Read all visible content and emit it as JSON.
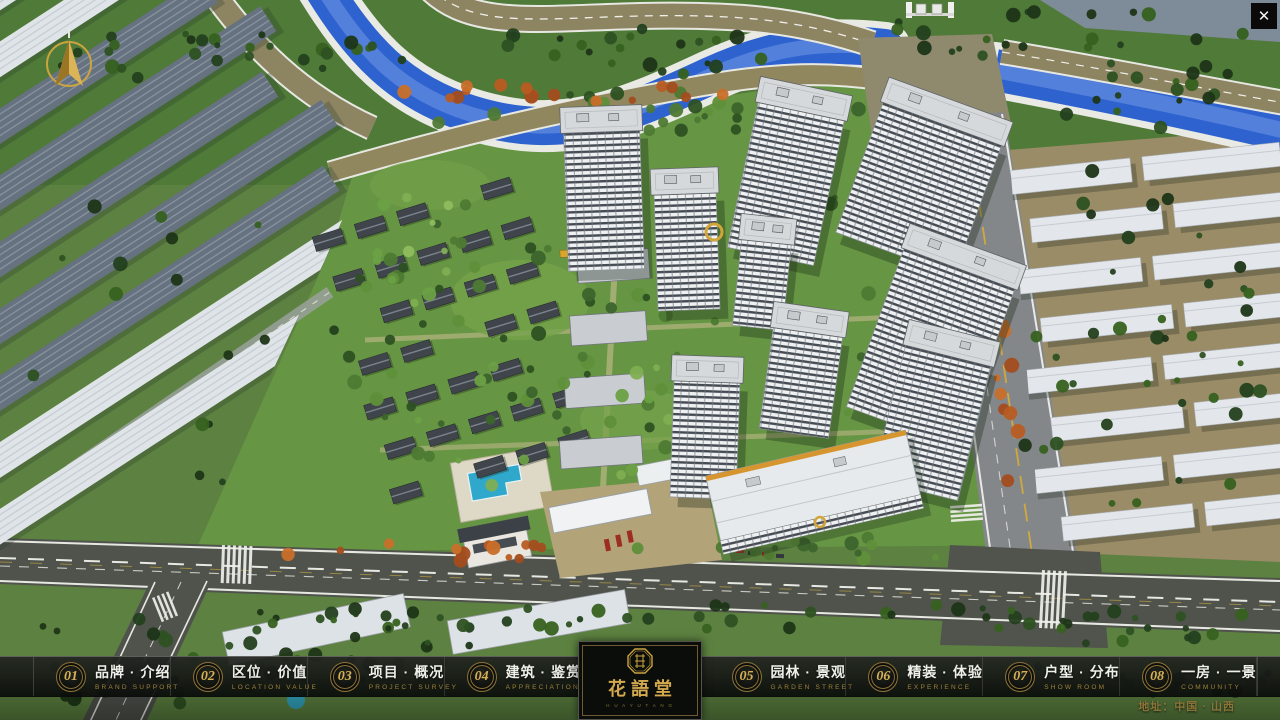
{
  "colors": {
    "gold": "#c9a43f",
    "nav_bg": "#0c0e0c",
    "water": "#2e62cf"
  },
  "window": {
    "close_icon": "✕"
  },
  "nav": {
    "items": [
      {
        "num": "01",
        "zh": "品牌 · 介绍",
        "en": "BRAND SUPPORT"
      },
      {
        "num": "02",
        "zh": "区位 · 价值",
        "en": "LOCATION VALUE"
      },
      {
        "num": "03",
        "zh": "项目 · 概况",
        "en": "PROJECT SURVEY"
      },
      {
        "num": "04",
        "zh": "建筑 · 鉴赏",
        "en": "APPRECIATION"
      },
      {
        "num": "05",
        "zh": "园林 · 景观",
        "en": "GARDEN STREET"
      },
      {
        "num": "06",
        "zh": "精装 · 体验",
        "en": "EXPERIENCE"
      },
      {
        "num": "07",
        "zh": "户型 · 分布",
        "en": "SHOW ROOM"
      },
      {
        "num": "08",
        "zh": "一房 · 一景",
        "en": "COMMUNITY"
      }
    ]
  },
  "logo": {
    "title": "花語堂",
    "tagline": "H U A Y U T A N G"
  },
  "footer": {
    "address": "地址：中国 · 山西"
  }
}
